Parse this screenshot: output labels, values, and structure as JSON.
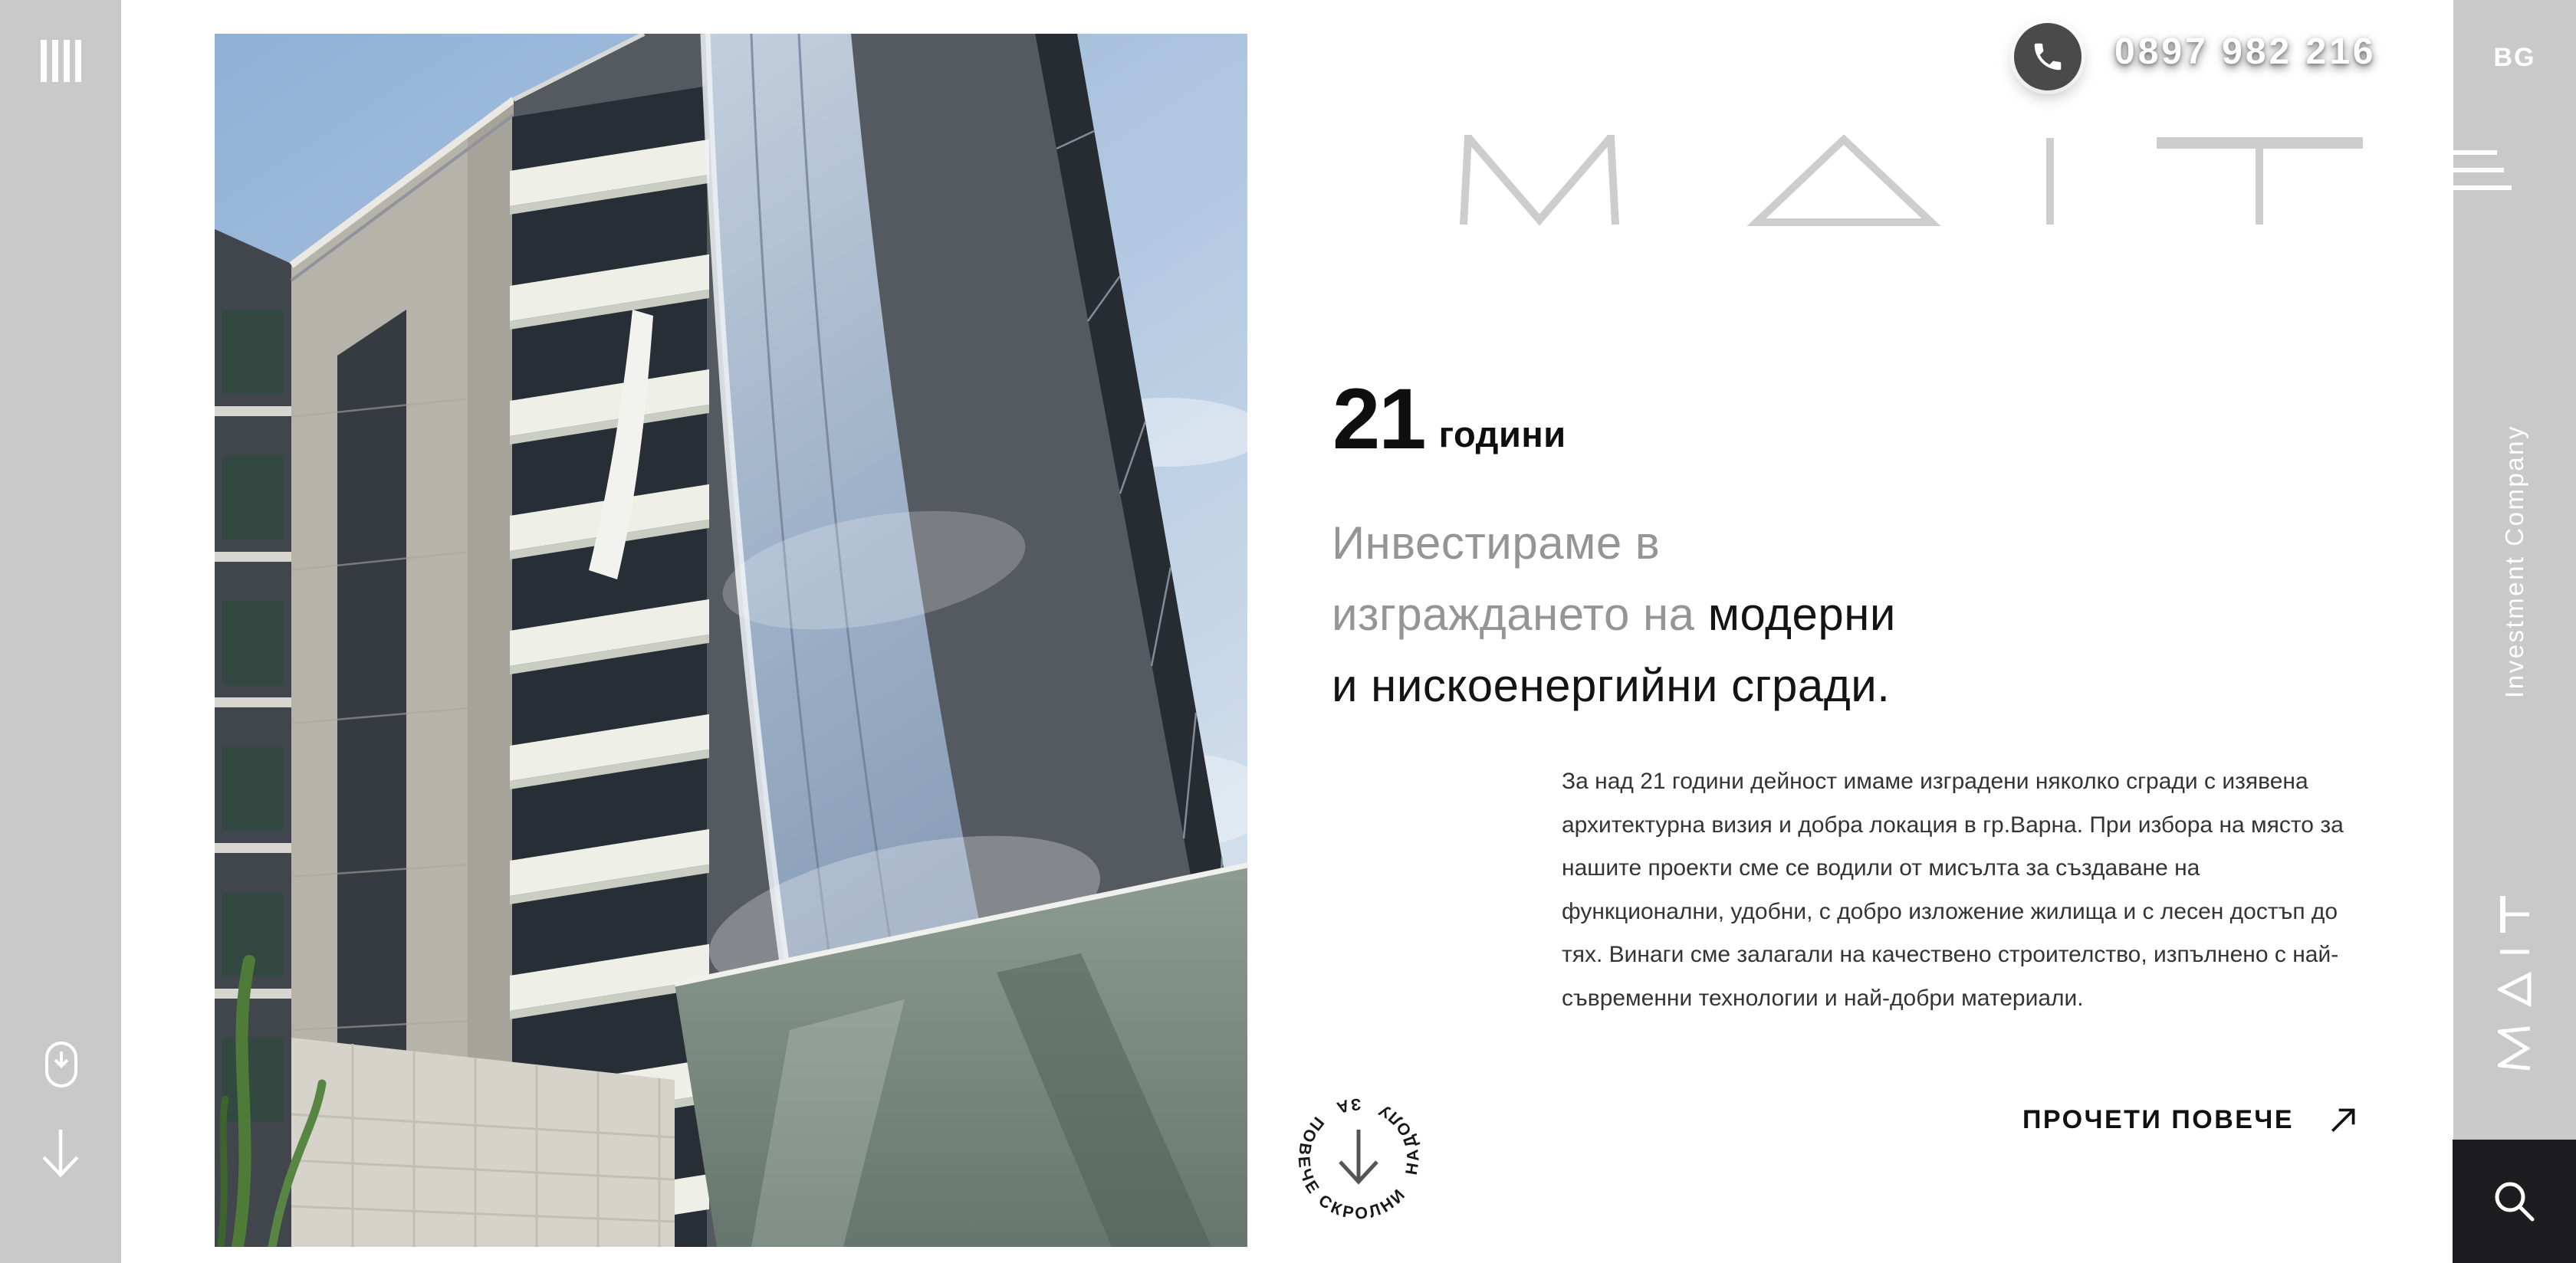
{
  "colors": {
    "rail_gray": "#c9c9c9",
    "page_bg": "#ffffff",
    "dark_panel": "#1d1d1f",
    "phone_circle": "#4a4a4a",
    "logo_gray": "#cdcdcd",
    "heading_gray": "#959595",
    "text_dark": "#141414",
    "body_text": "#343434"
  },
  "left_rail": {
    "bars_icon": "four-vertical-bars",
    "mouse_icon": "mouse-scroll",
    "arrow_icon": "arrow-down"
  },
  "topbar": {
    "phone_number": "0897 982 216",
    "phone_icon": "phone-handset",
    "language": "BG"
  },
  "logo": {
    "text": "M Δ I T"
  },
  "right_rail": {
    "menu_icon": "hamburger-menu",
    "tagline": "Investment Company",
    "vertical_logo": "M Δ I T",
    "search_icon": "magnifier"
  },
  "hero": {
    "years_value": "21",
    "years_label": "години",
    "heading_line1_gray": "Инвестираме в",
    "heading_line2_gray": "изграждането на ",
    "heading_line2_dark": "модерни",
    "heading_line3_dark": "и нискоенергийни сгради.",
    "paragraph": "За над 21 години дейност имаме изградени няколко сгради с изявена архитектурна визия и добра локация в гр.Варна. При избора на място за нашите проекти сме се водили от мисълта за създаване на функционални, удобни, с добро изложение жилища и с лесен достъп до тях. Винаги сме залагали на качествено строителство, изпълнено с най-съвременни технологии и най-добри материали.",
    "read_more": "ПРОЧЕТИ ПОВЕЧЕ",
    "read_more_icon": "arrow-up-right"
  },
  "scroll_badge": {
    "text": "СКРОЛНИ НАДОЛУ ЗА ПОВЕЧЕ",
    "icon": "arrow-down"
  }
}
